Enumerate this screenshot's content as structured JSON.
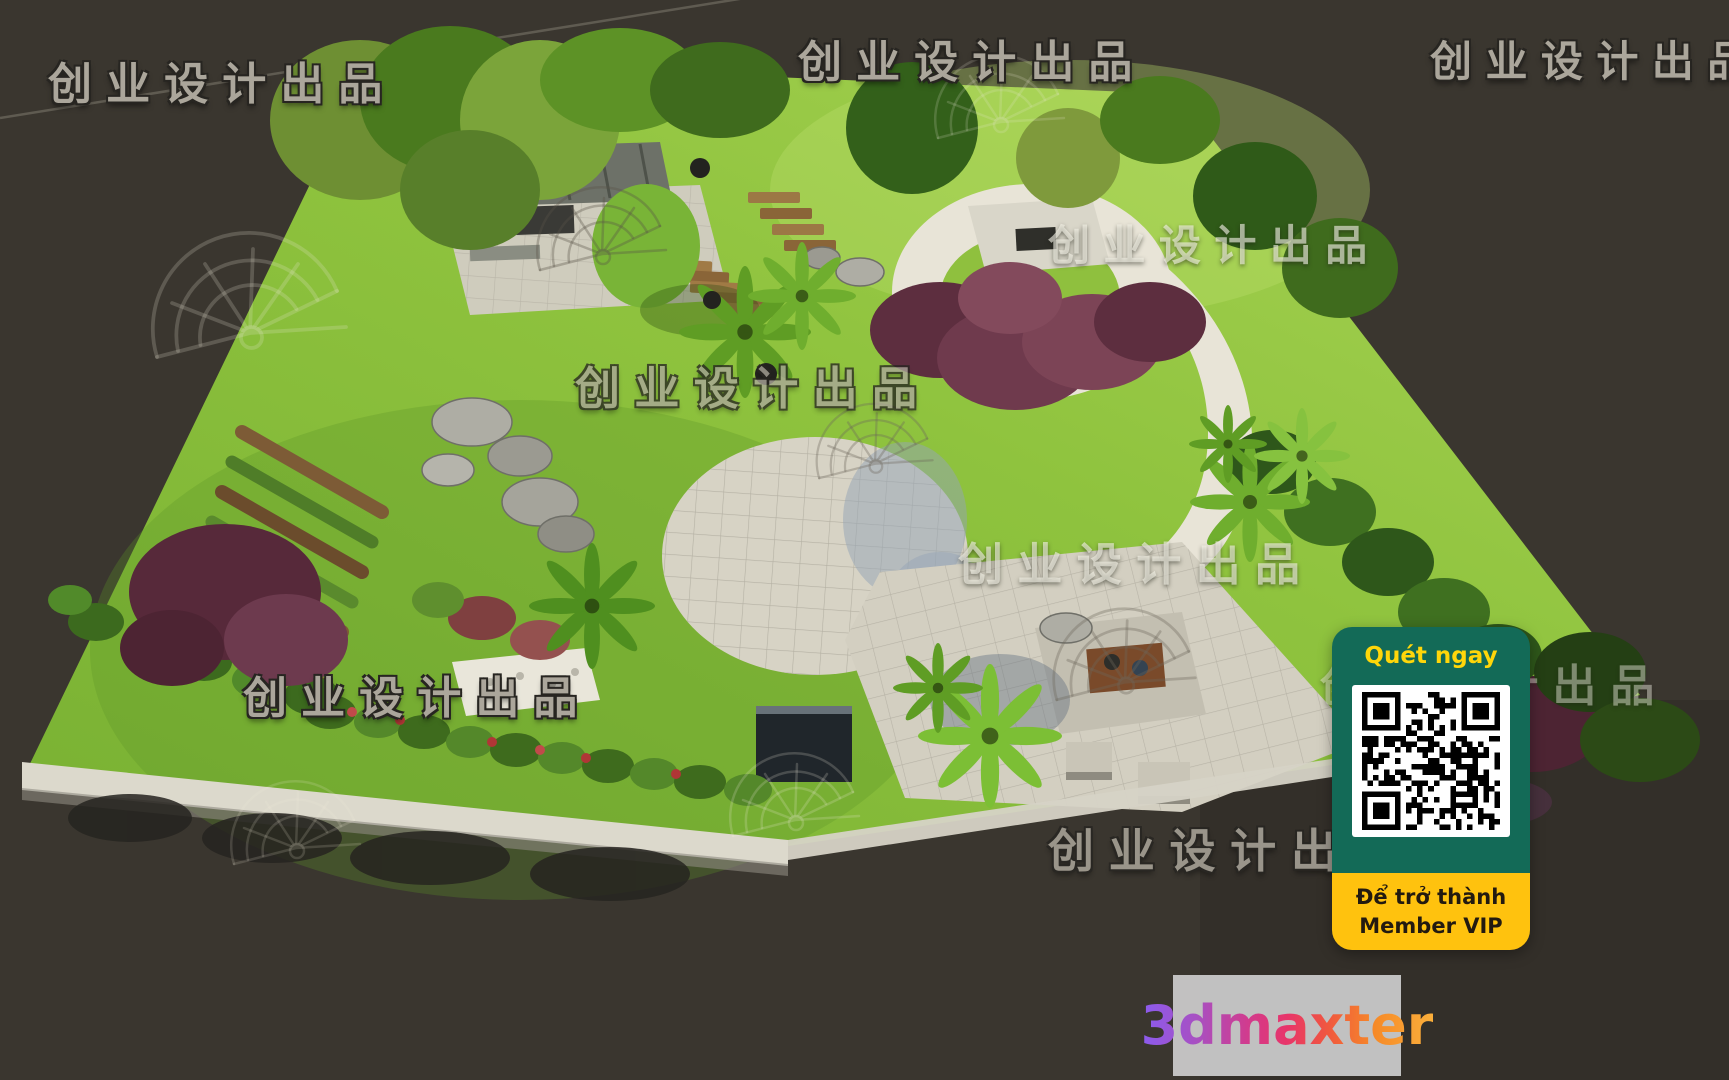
{
  "watermark": {
    "text": "创业设计出品",
    "color": "#ABA69B"
  },
  "qr_badge": {
    "scan_label": "Quét ngay",
    "member_line1": "Để trở thành",
    "member_line2": "Member VIP",
    "colors": {
      "panel_green": "#136A57",
      "panel_yellow": "#FFC20E",
      "scan_label_color": "#FFD60A",
      "member_text_color": "#231A10",
      "qr_foreground": "#000000",
      "qr_background": "#FFFFFF"
    }
  },
  "brand": {
    "text": "3dmaxter",
    "gradient_colors": [
      "#8A5CF0",
      "#D43A8A",
      "#F68A28",
      "#FBB03B"
    ],
    "panel_background": "#C9C9C9"
  }
}
